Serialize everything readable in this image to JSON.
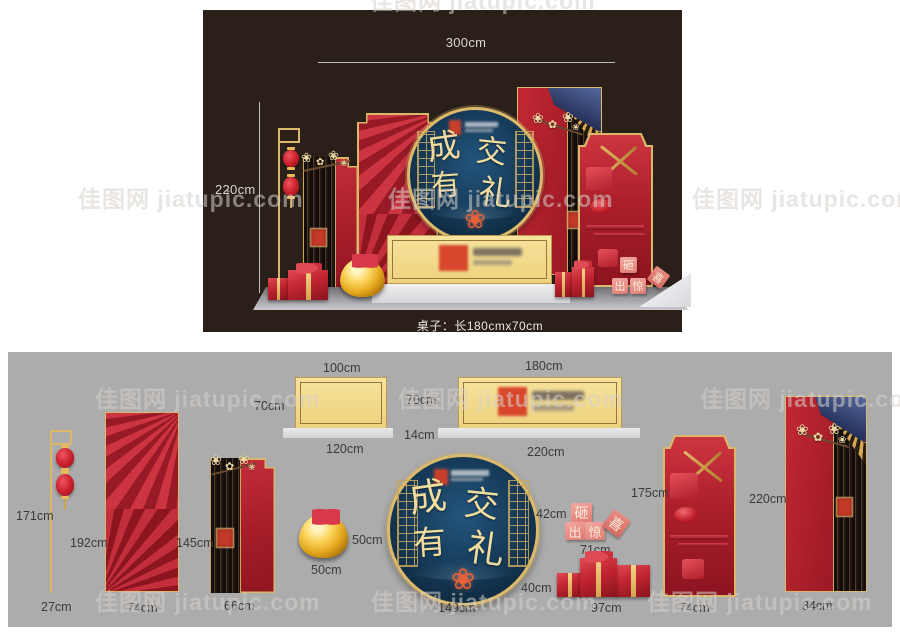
{
  "watermark": {
    "text": "佳图网 jiatupic.com"
  },
  "colors": {
    "accent_gold": "#D9B86A",
    "panel_red": "#B01F2E",
    "medallion_navy": "#16324D",
    "banner_yellow": "#F3DB8E",
    "dark_bg": "#2B2019",
    "gray_bg": "#ACACAC"
  },
  "top_panel": {
    "width_dim": "300cm",
    "height_dim": "220cm",
    "caption": "桌子：长180cmx70cm",
    "medallion_chars": [
      "成",
      "交",
      "有",
      "礼"
    ],
    "smash_chars": [
      "砸",
      "出",
      "惊",
      "喜"
    ]
  },
  "bottom_panel": {
    "lantern_pole": {
      "height": "171cm",
      "width": "27cm"
    },
    "fan_panel": {
      "height": "192cm",
      "width": "74cm"
    },
    "striped_panel": {
      "height": "145cm",
      "width": "66cm"
    },
    "framed_board": {
      "width": "100cm",
      "height": "70cm",
      "base_width": "120cm"
    },
    "banner_board": {
      "width": "180cm",
      "height": "70cm",
      "base_height": "14cm",
      "base_width": "220cm"
    },
    "gold_ingot": {
      "height": "50cm",
      "width": "50cm"
    },
    "medallion": {
      "width": "149cm",
      "chars": [
        "成",
        "交",
        "有",
        "礼"
      ]
    },
    "smash_blocks": {
      "height": "42cm",
      "width": "71cm",
      "chars": [
        "砸",
        "出",
        "惊",
        "喜"
      ]
    },
    "gift_boxes": {
      "height": "40cm",
      "width": "97cm"
    },
    "arch_panel": {
      "height": "175cm",
      "width": "74cm"
    },
    "eave_panel": {
      "height": "220cm",
      "width": "84cm"
    }
  }
}
